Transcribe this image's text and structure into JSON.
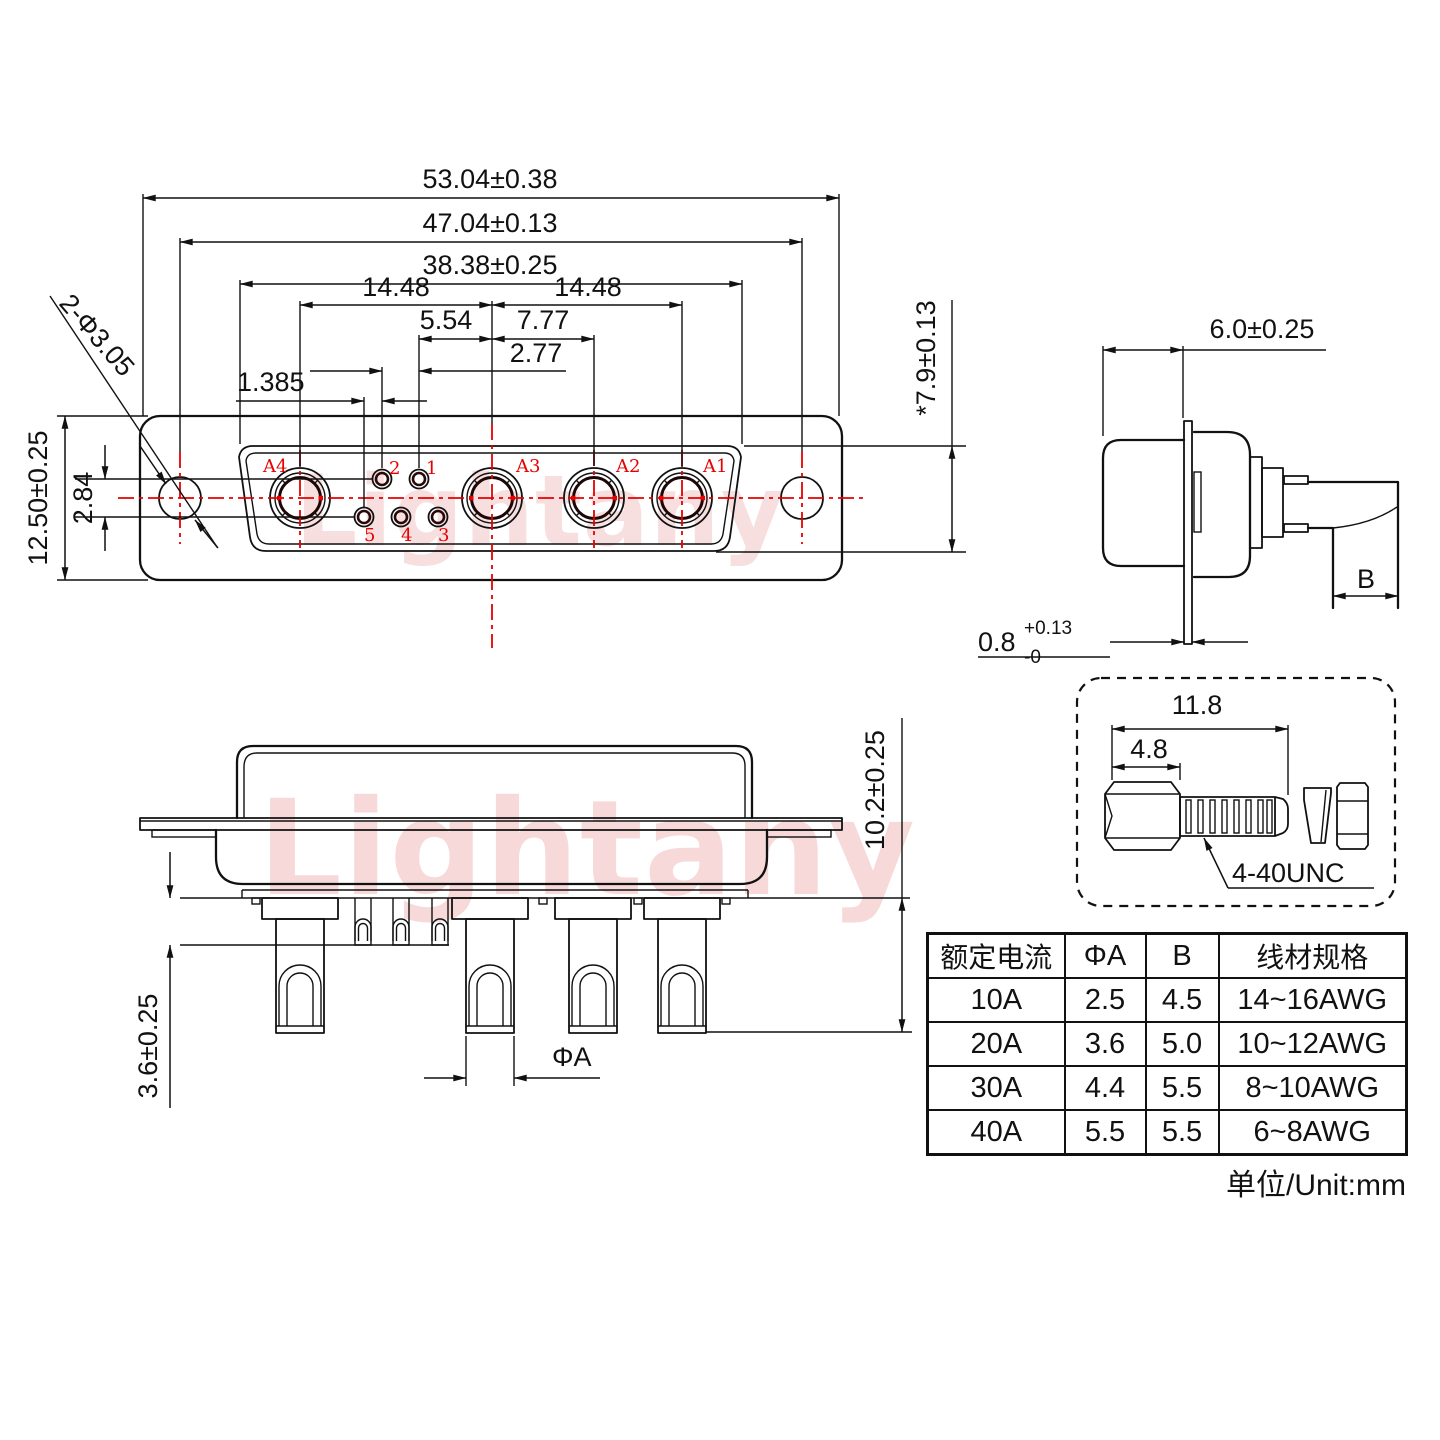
{
  "watermark": "Lightany",
  "front": {
    "dims": {
      "overall_width": "53.04±0.38",
      "mount_spacing": "47.04±0.13",
      "insert_width": "38.38±0.25",
      "pitch_left": "14.48",
      "pitch_right": "14.48",
      "d_5_54": "5.54",
      "d_7_77": "7.77",
      "d_2_77": "2.77",
      "d_1_385": "1.385",
      "d_2_84": "2.84",
      "body_height": "12.50±0.25",
      "insert_height": "*7.9±0.13",
      "mount_hole": "2-Φ3.05"
    },
    "pins": {
      "a1": "A1",
      "a2": "A2",
      "a3": "A3",
      "a4": "A4",
      "n1": "1",
      "n2": "2",
      "n3": "3",
      "n4": "4",
      "n5": "5"
    }
  },
  "side": {
    "dims": {
      "depth": "6.0±0.25",
      "flange_t": "0.8",
      "flange_sup": "+0.13",
      "flange_sub": "-0",
      "wire_b": "B"
    }
  },
  "bottom": {
    "dims": {
      "cup_len": "10.2±0.25",
      "pin_len": "3.6±0.25",
      "pin_dia": "ΦA"
    }
  },
  "screw": {
    "total_len": "11.8",
    "head_len": "4.8",
    "thread": "4-40UNC"
  },
  "table": {
    "headers": [
      "额定电流",
      "ΦA",
      "B",
      "线材规格"
    ],
    "rows": [
      [
        "10A",
        "2.5",
        "4.5",
        "14~16AWG"
      ],
      [
        "20A",
        "3.6",
        "5.0",
        "10~12AWG"
      ],
      [
        "30A",
        "4.4",
        "5.5",
        "8~10AWG"
      ],
      [
        "40A",
        "5.5",
        "5.5",
        "6~8AWG"
      ]
    ]
  },
  "note": "单位/Unit:mm",
  "colors": {
    "line": "#111111",
    "accent": "#e60000",
    "watermark": "#f0b4b4"
  }
}
